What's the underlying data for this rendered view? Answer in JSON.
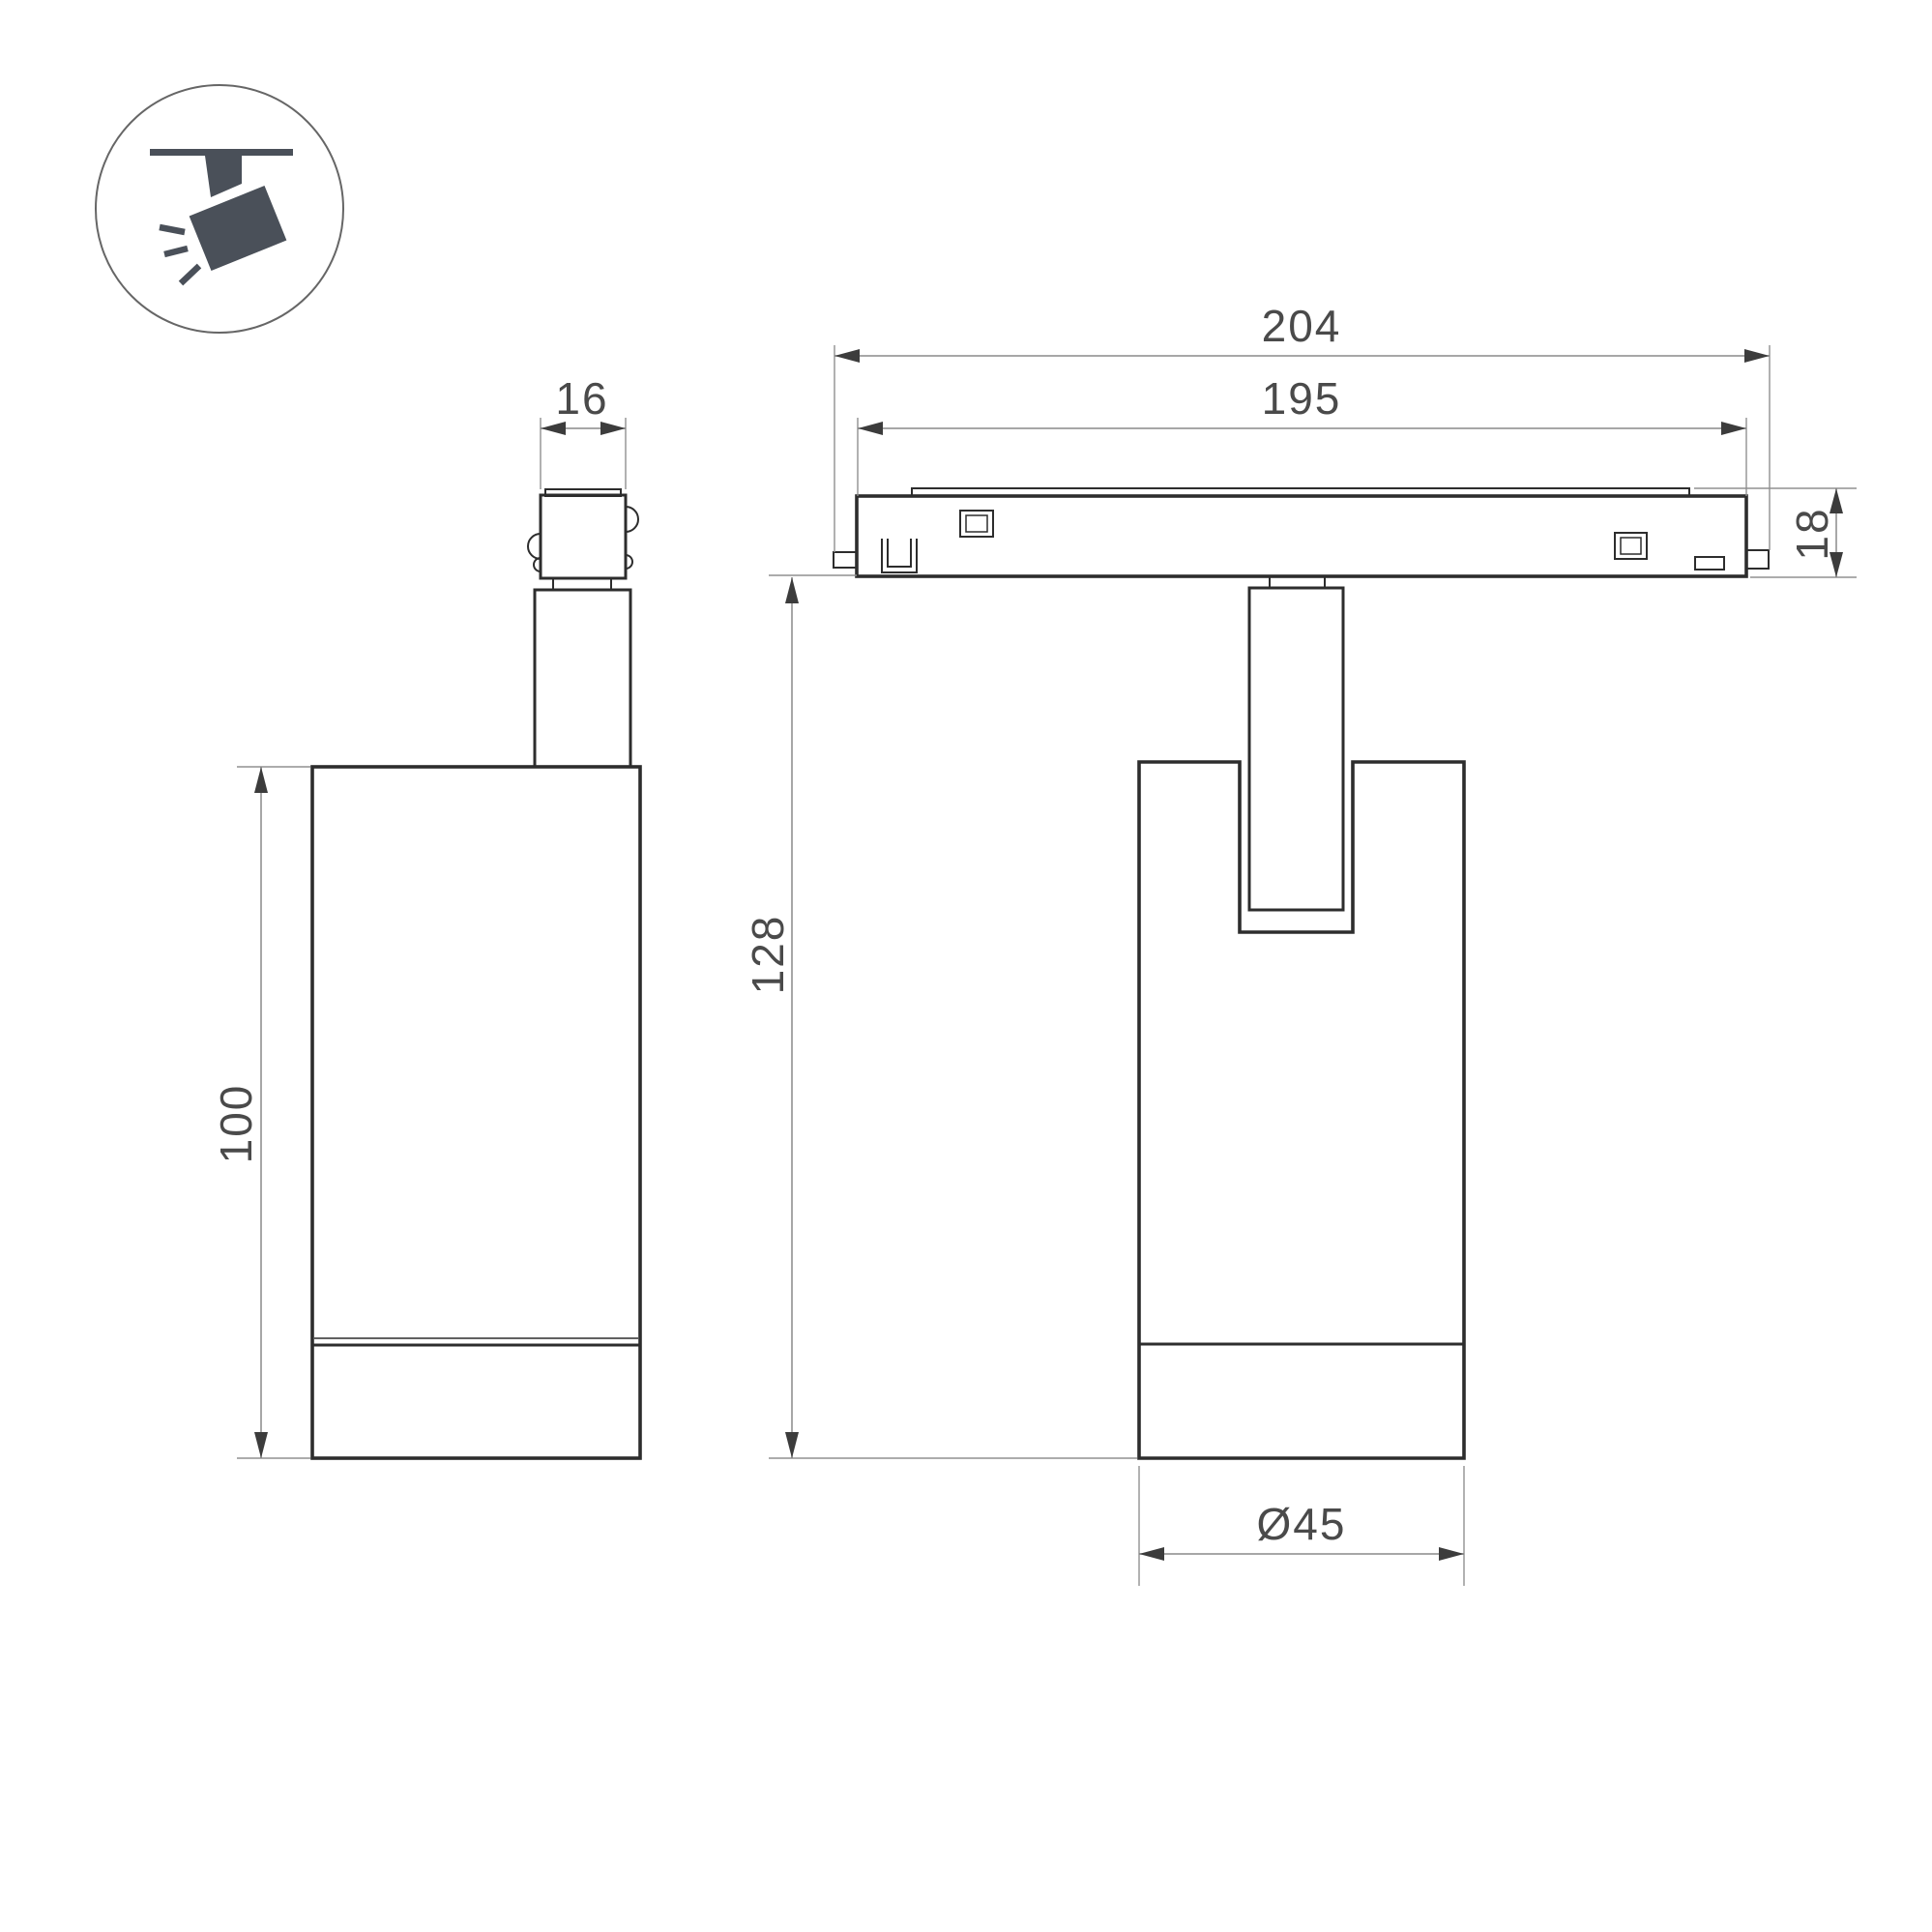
{
  "drawing": {
    "title": "track-spotlight-dimension-drawing",
    "colors": {
      "object_line": "#2d2d2d",
      "dimension_line": "#8a8a8a",
      "text": "#4a4a4a",
      "icon": "#4a5059",
      "background": "#ffffff"
    },
    "icon": {
      "name": "ceiling-track-spotlight-pictogram"
    },
    "dimensions": {
      "adapter_width": "16",
      "body_height": "100",
      "track_outer_length": "204",
      "track_inner_length": "195",
      "track_height": "18",
      "total_height": "128",
      "body_diameter": "Ø45"
    }
  }
}
